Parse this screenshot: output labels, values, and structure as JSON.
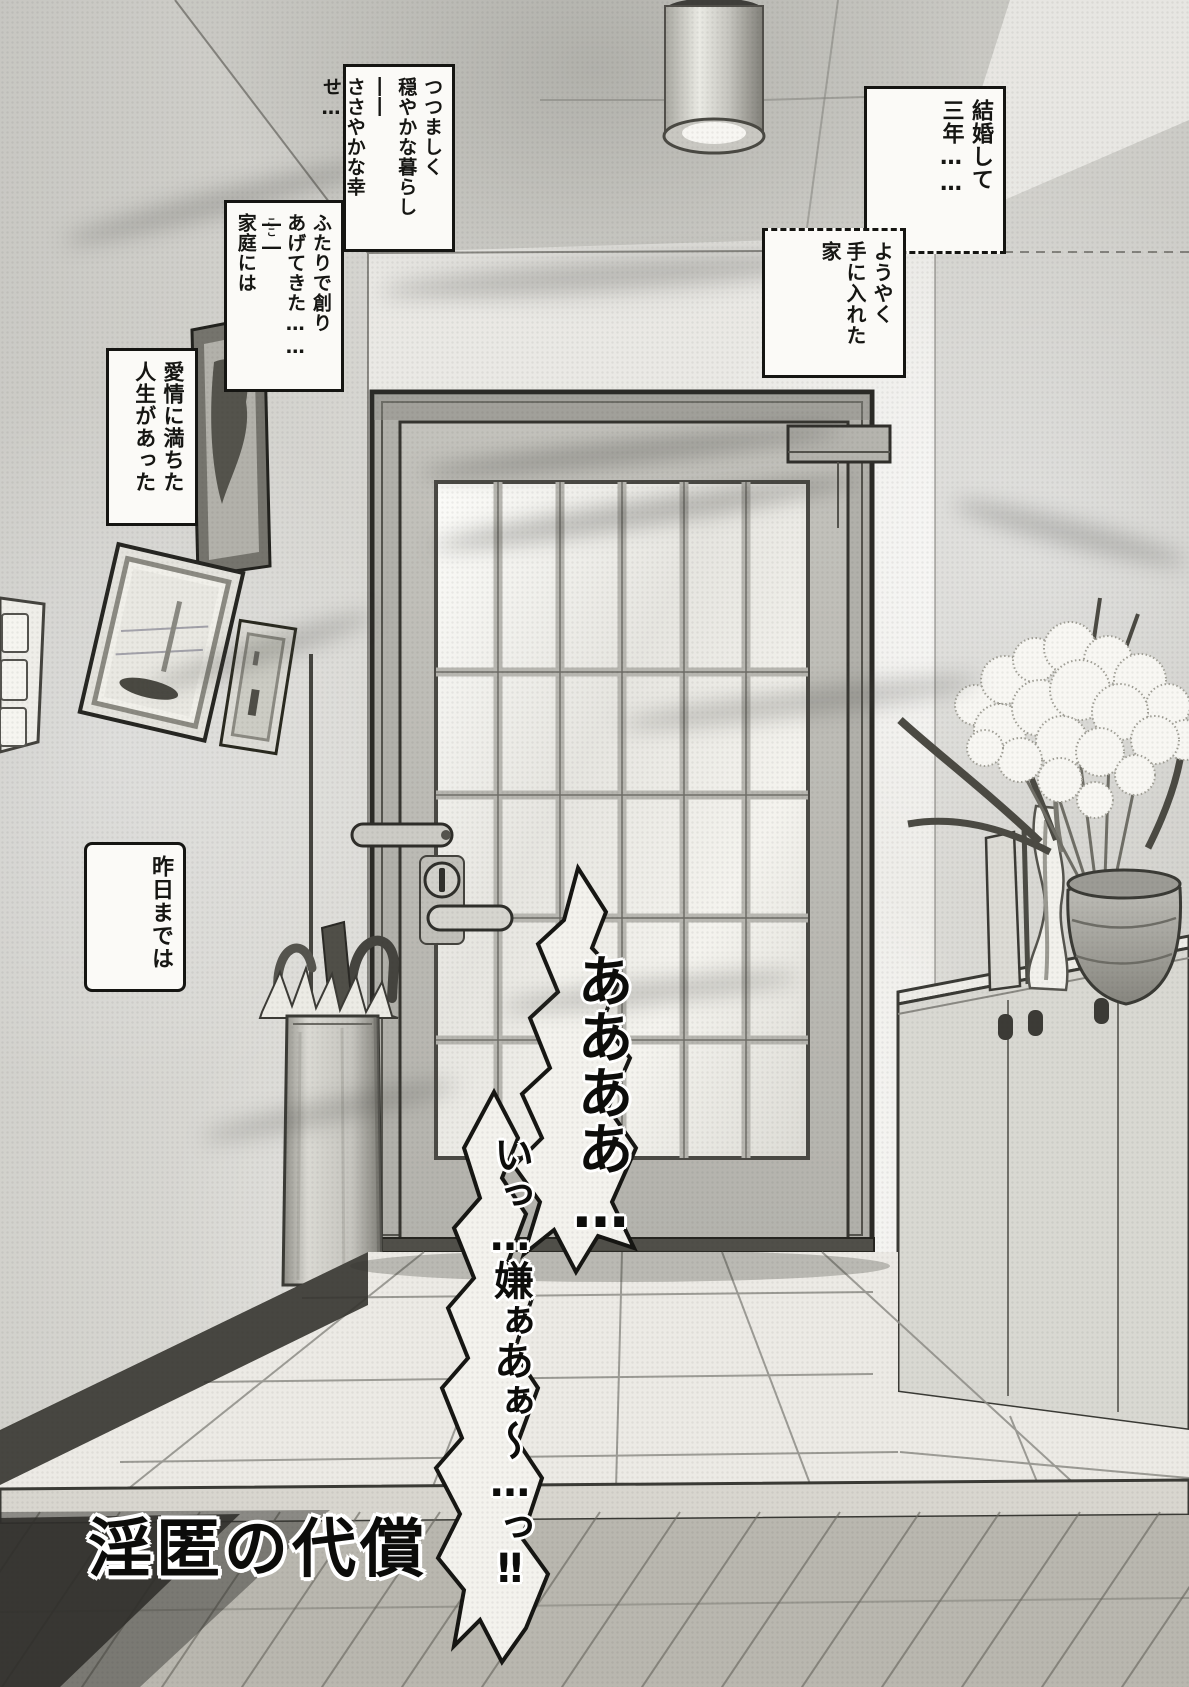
{
  "colors": {
    "ink": "#161613",
    "paper": "#efeeea",
    "bubble_fill": "#f3f2ed"
  },
  "narration": {
    "box1": {
      "lines": [
        "つつましく",
        "穏やかな暮らし",
        "――",
        "ささやかな幸せ…"
      ]
    },
    "box2": {
      "lines": [
        "ふたりで創り",
        "あげてきた……――",
        "家庭には"
      ],
      "furigana": "ここ"
    },
    "box3": {
      "lines": [
        "愛情に満ちた",
        "人生があった"
      ]
    },
    "box4": {
      "lines": [
        "昨日までは"
      ]
    },
    "box5": {
      "lines": [
        "結婚して",
        "三年……"
      ]
    },
    "box6": {
      "lines": [
        "ようやく",
        "手に入れた家"
      ]
    }
  },
  "scream": {
    "line1": "ああああ…",
    "line2": "いっ…嫌ぁあぁ～…っ‼"
  },
  "title": {
    "text": "淫匿の代償"
  }
}
